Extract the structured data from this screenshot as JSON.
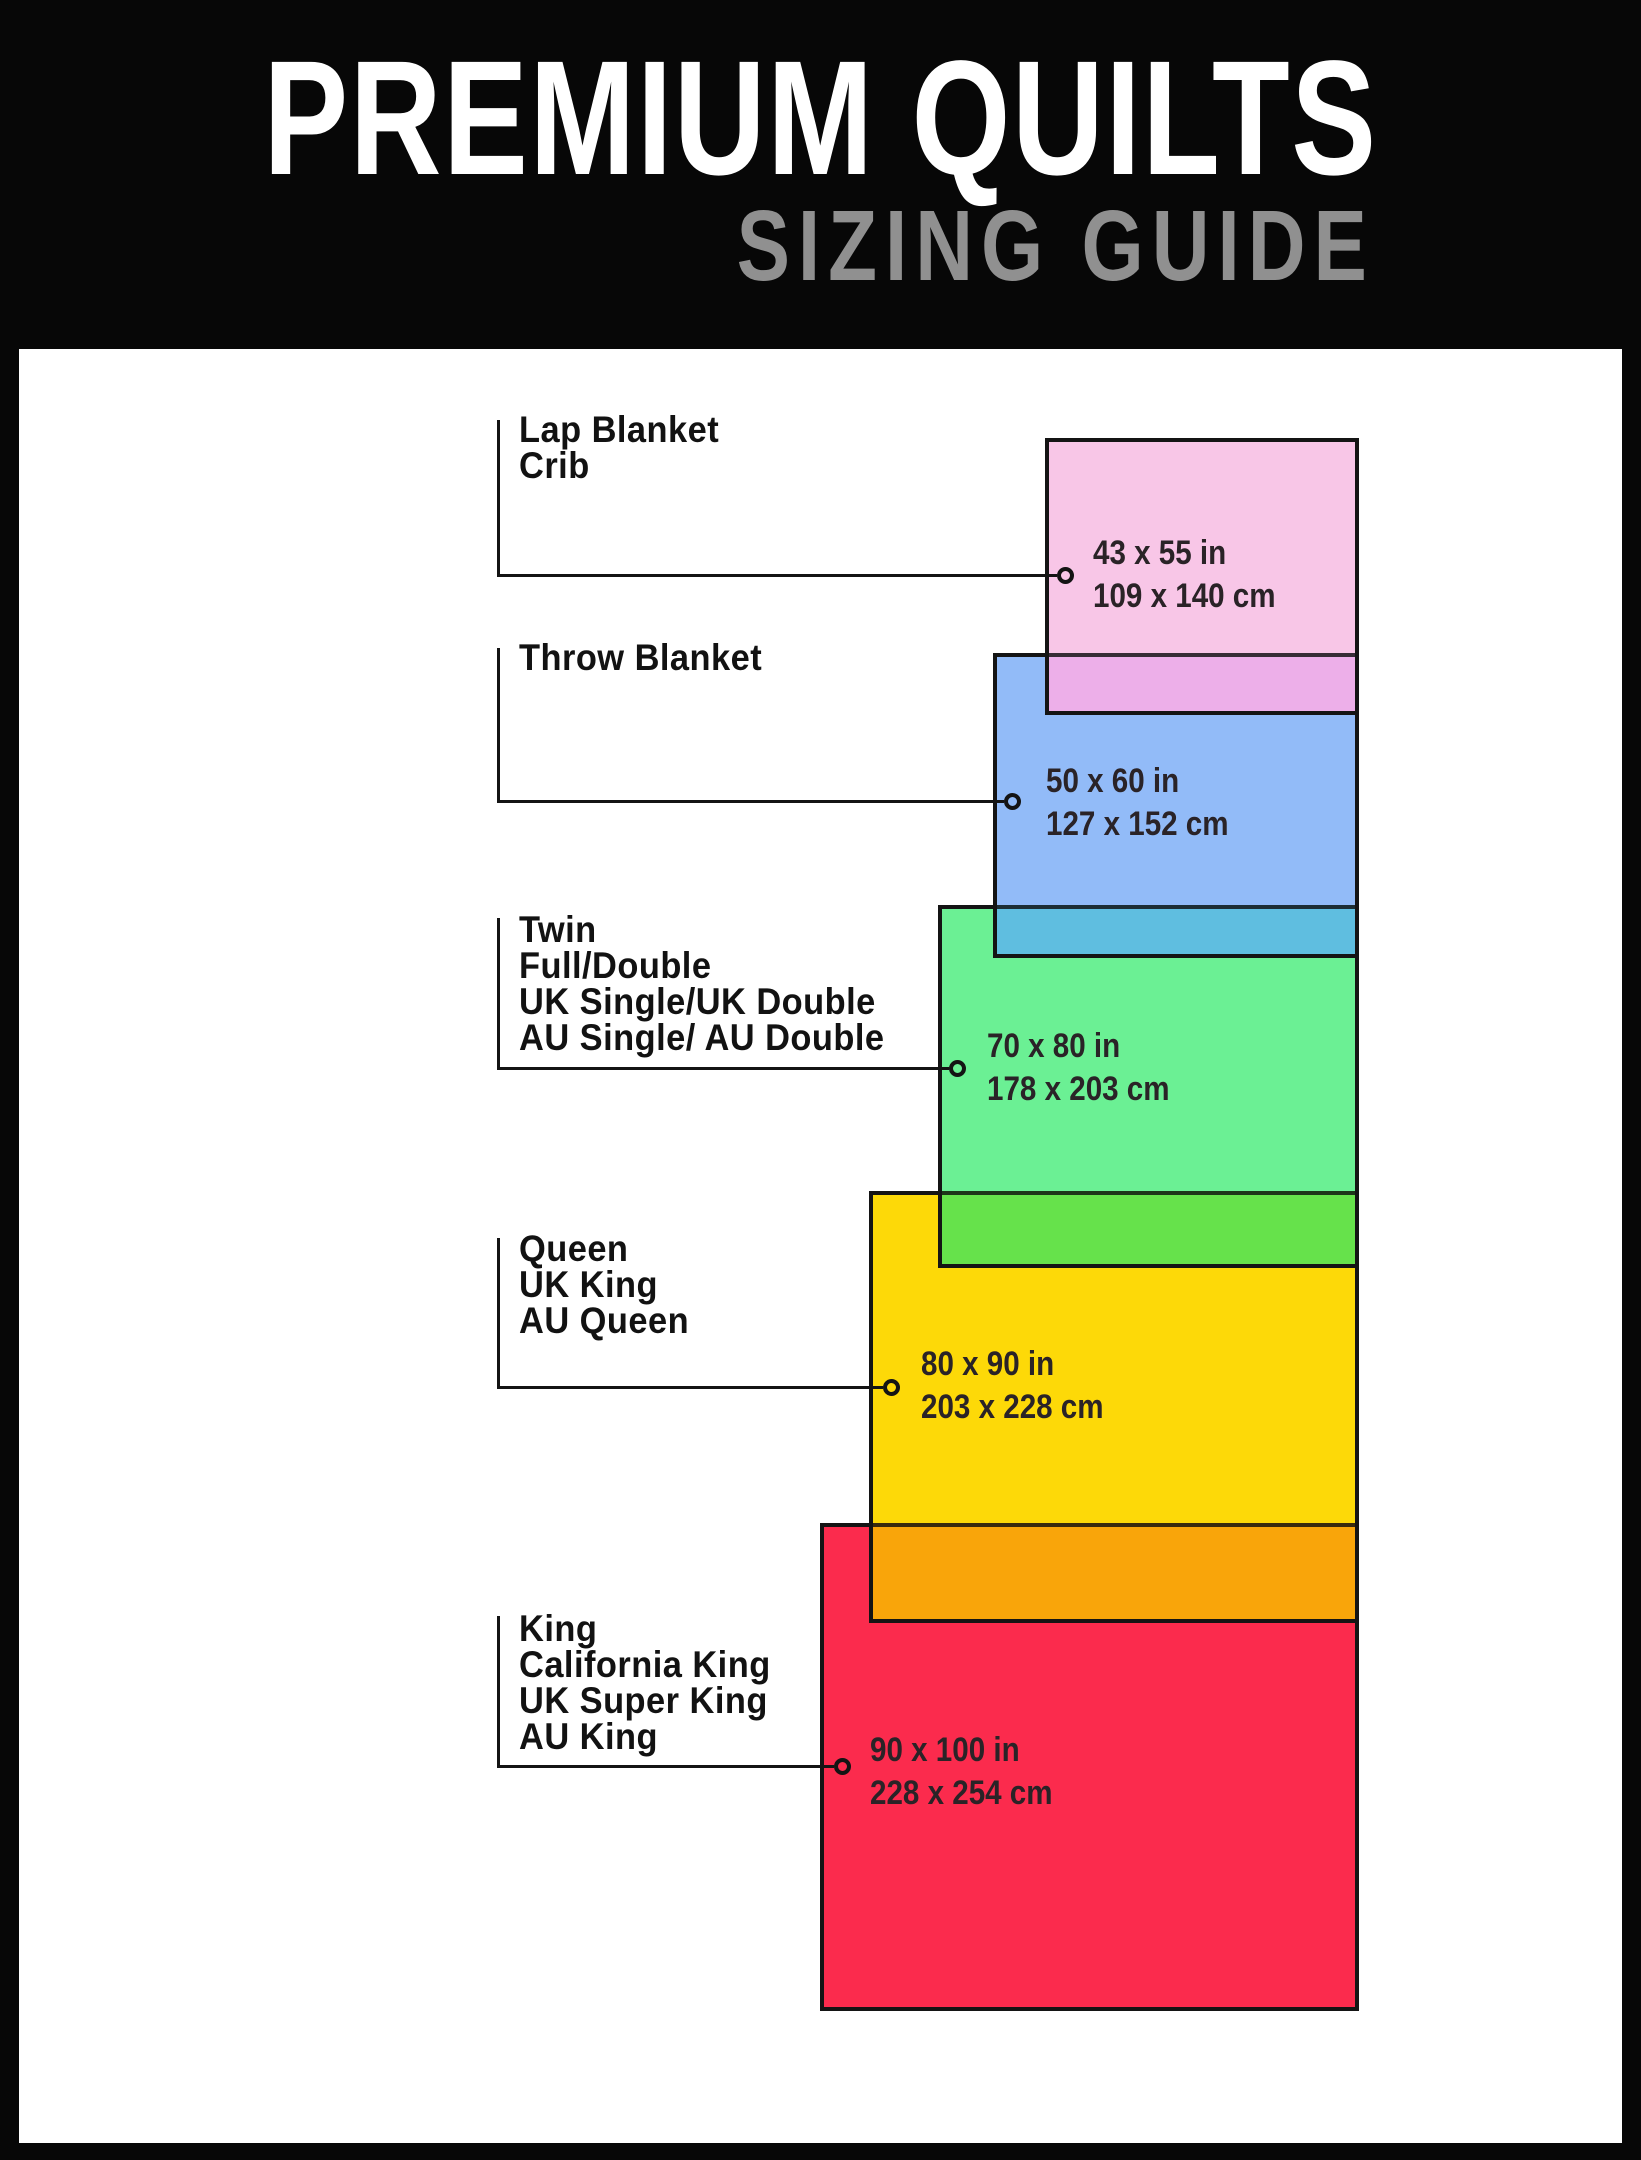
{
  "header": {
    "title": "PREMIUM QUILTS",
    "subtitle": "SIZING GUIDE"
  },
  "colors": {
    "background": "#070707",
    "panel": "#ffffff",
    "title_text": "#ffffff",
    "subtitle_text": "#909090",
    "outline": "#141414",
    "label_text": "#121212",
    "dims_text": "#2a2327"
  },
  "sizes": [
    {
      "id": "lap-blanket-crib",
      "labels": [
        "Lap Blanket",
        "Crib"
      ],
      "inches": "43 x 55 in",
      "centimeters": "109 x 140 cm",
      "fill": "#F8C6E7",
      "overlap_fill": "#EDAFE9"
    },
    {
      "id": "throw-blanket",
      "labels": [
        "Throw Blanket"
      ],
      "inches": "50 x 60 in",
      "centimeters": "127 x 152 cm",
      "fill": "#92BBF8",
      "overlap_fill": "#5FBEE0"
    },
    {
      "id": "twin-full-double",
      "labels": [
        "Twin",
        "Full/Double",
        "UK Single/UK Double",
        "AU Single/ AU Double"
      ],
      "inches": "70 x 80 in",
      "centimeters": "178 x 203 cm",
      "fill": "#6BF094",
      "overlap_fill": "#66E24B"
    },
    {
      "id": "queen-uk-king-au-queen",
      "labels": [
        "Queen",
        "UK King",
        "AU Queen"
      ],
      "inches": "80 x 90 in",
      "centimeters": "203 x 228 cm",
      "fill": "#FDD908",
      "overlap_fill": "#F9A50A"
    },
    {
      "id": "king-california-king",
      "labels": [
        "King",
        "California King",
        "UK Super King",
        "AU King"
      ],
      "inches": "90 x 100 in",
      "centimeters": "228 x 254 cm",
      "fill": "#FB2B4D",
      "overlap_fill": null
    }
  ]
}
